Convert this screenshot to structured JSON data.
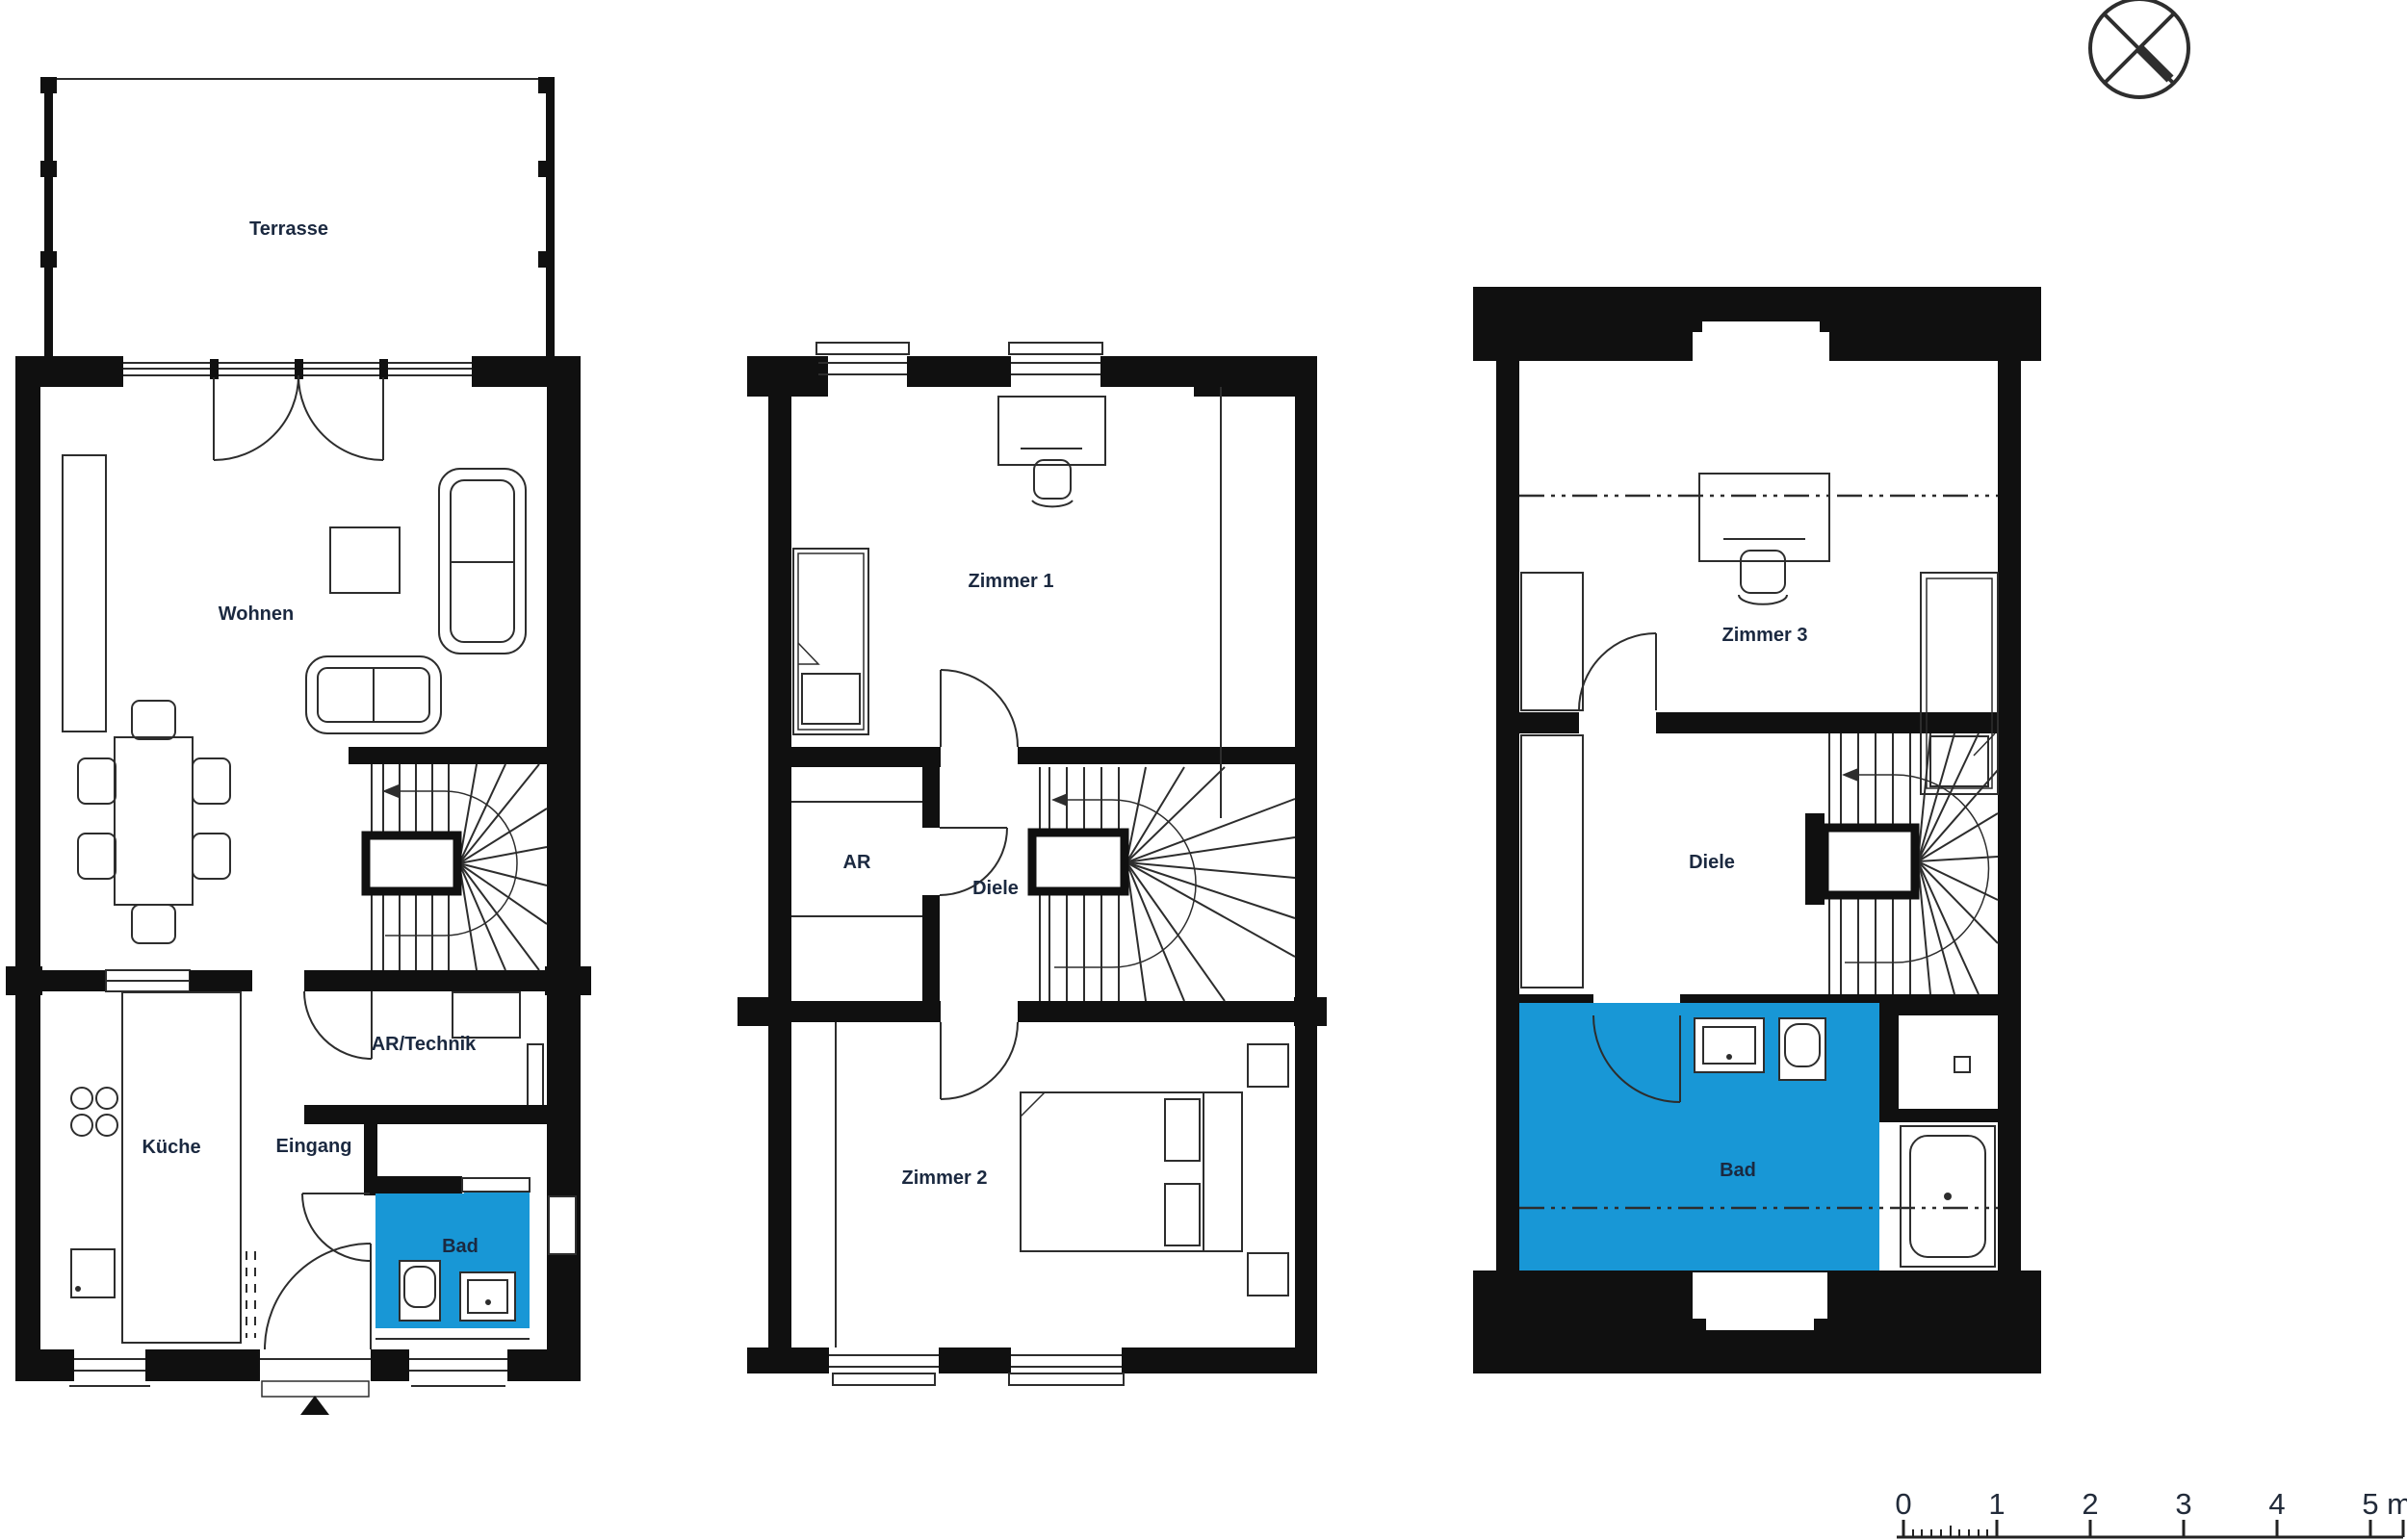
{
  "document": {
    "type": "architectural-floor-plan",
    "background": "#ffffff"
  },
  "colors": {
    "walls": "#101010",
    "lines": "#2d2d2d",
    "text": "#1b2940",
    "bath_highlight": "#1897d6"
  },
  "plans": {
    "ground_floor": {
      "terrasse": "Terrasse",
      "wohnen": "Wohnen",
      "kueche": "Küche",
      "eingang": "Eingang",
      "ar_technik": "AR/Technik",
      "bad": "Bad"
    },
    "upper_floor": {
      "zimmer_1": "Zimmer 1",
      "ar": "AR",
      "diele": "Diele",
      "zimmer_2": "Zimmer 2"
    },
    "attic": {
      "zimmer_3": "Zimmer 3",
      "diele": "Diele",
      "bad": "Bad"
    }
  },
  "north_indicator": {
    "icon": "crossed-circle-north-symbol"
  },
  "scale_bar": {
    "labels": [
      "0",
      "1",
      "2",
      "3",
      "4",
      "5"
    ],
    "unit": "m"
  }
}
